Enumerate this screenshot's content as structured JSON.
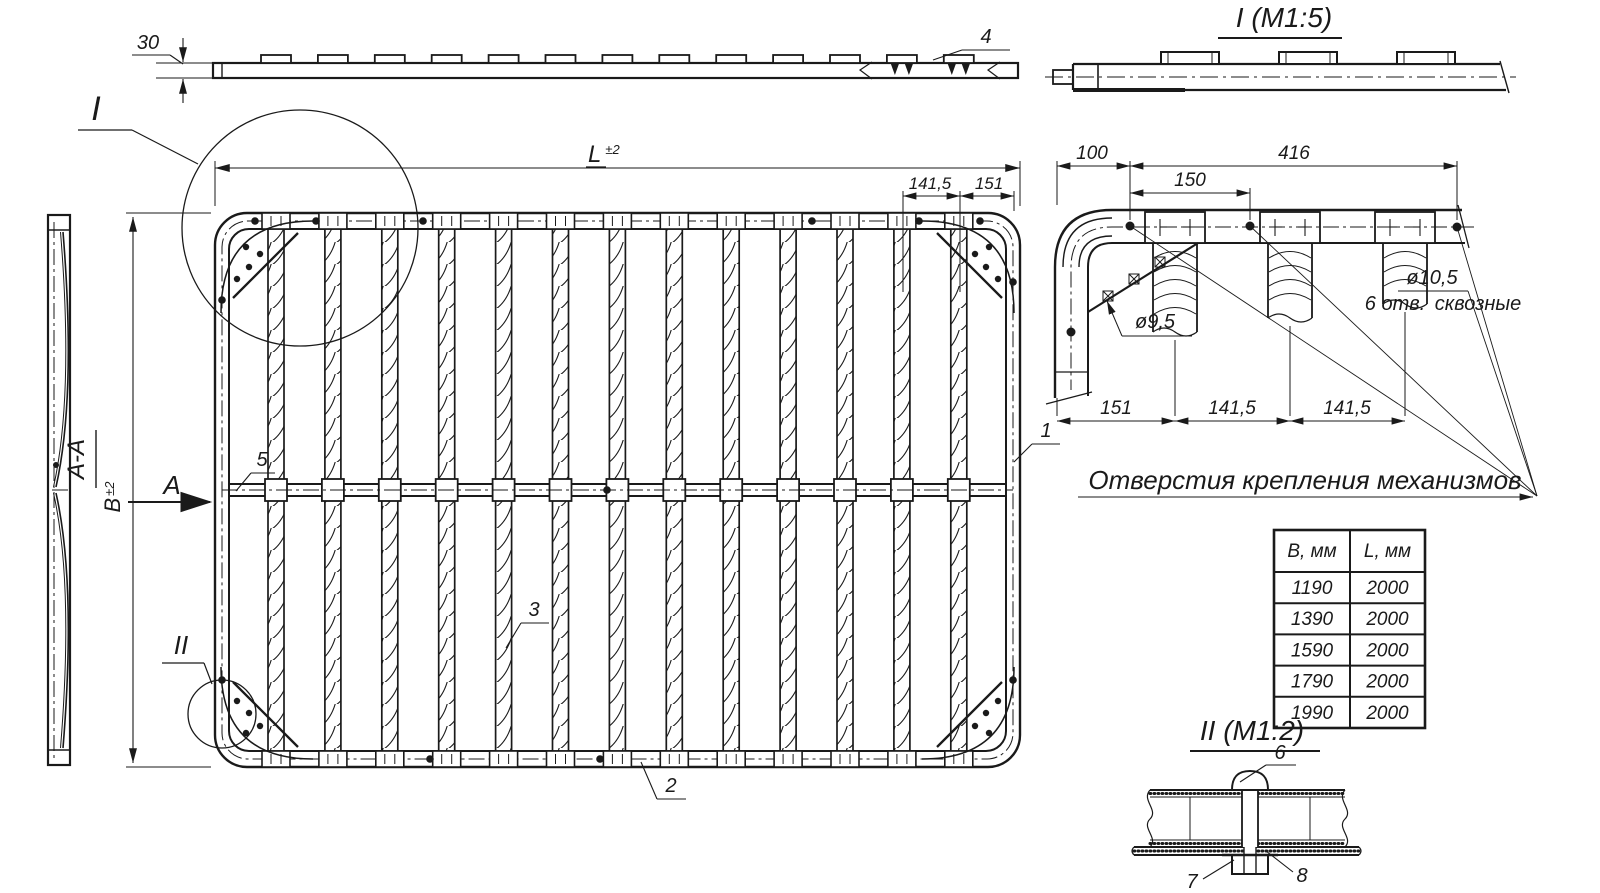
{
  "colors": {
    "ink": "#1a1a1a",
    "paper": "#ffffff"
  },
  "top_view": {
    "thickness_dim": "30",
    "bracket_callout": "4",
    "tab_count": 13
  },
  "detail_I": {
    "title": "I (M1:5)"
  },
  "main_view": {
    "slat_count": 13,
    "length_letter": "L",
    "length_tol": "±2",
    "width_letter": "В",
    "width_tol": "±2",
    "pitch_dim": "141,5",
    "edge_dim": "151",
    "detail_I_mark": "I",
    "detail_II_mark": "II",
    "section_arrow": "A",
    "section_title": "A-A",
    "callout_frame": "1",
    "callout_bottom_rail": "2",
    "callout_slat": "3",
    "callout_middle_rail": "5"
  },
  "corner_detail": {
    "dim_corner_to_hole": "100",
    "dim_hole_span": "416",
    "dim_hole_pitch": "150",
    "dim_edge": "151",
    "dim_pitch_a": "141,5",
    "dim_pitch_b": "141,5",
    "rivet_hole_dia": "ø9,5",
    "mount_hole_dia": "ø10,5",
    "mount_hole_count": "6 отв.",
    "mount_hole_type": "сквозные"
  },
  "mount_note": "Отверстия крепления механизмов",
  "size_table": {
    "headers": [
      "В, мм",
      "L, мм"
    ],
    "rows": [
      [
        "1190",
        "2000"
      ],
      [
        "1390",
        "2000"
      ],
      [
        "1590",
        "2000"
      ],
      [
        "1790",
        "2000"
      ],
      [
        "1990",
        "2000"
      ]
    ]
  },
  "detail_II": {
    "title": "II (M1:2)",
    "callout_screw": "6",
    "callout_nut": "7",
    "callout_washer": "8"
  }
}
